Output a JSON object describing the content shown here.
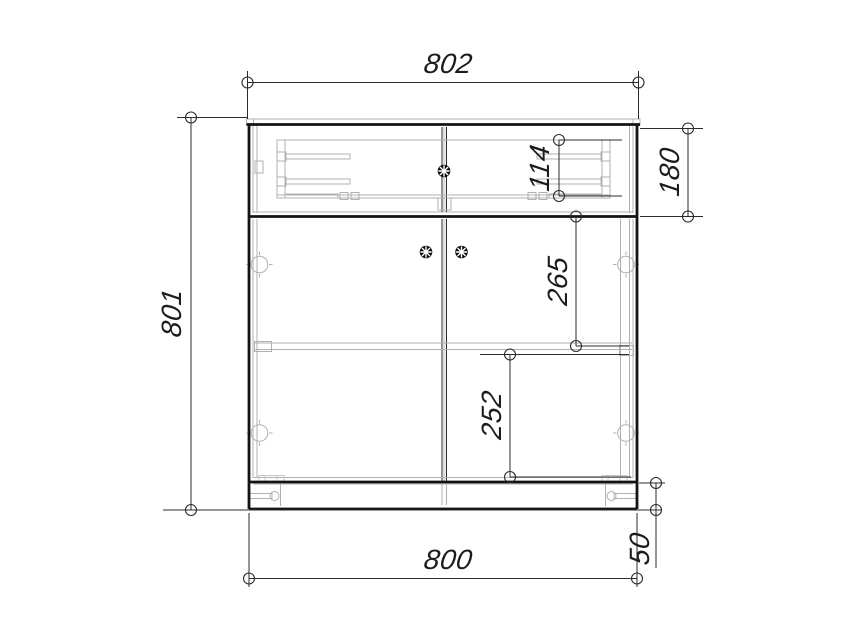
{
  "drawing": {
    "type": "cad-front-view-cabinet",
    "dimensions": {
      "width_top": "802",
      "height_overall": "801",
      "width_bottom": "800",
      "drawer_section_height": "180",
      "drawer_box_height": "114",
      "upper_compartment_height": "265",
      "lower_compartment_height": "252",
      "plinth_height": "50"
    },
    "colors": {
      "background": "#ffffff",
      "outline": "#131313",
      "dimension_lines": "#2b2b2b",
      "hidden_detail": "#b0b0b0",
      "knob": "#0d0d0d"
    }
  }
}
